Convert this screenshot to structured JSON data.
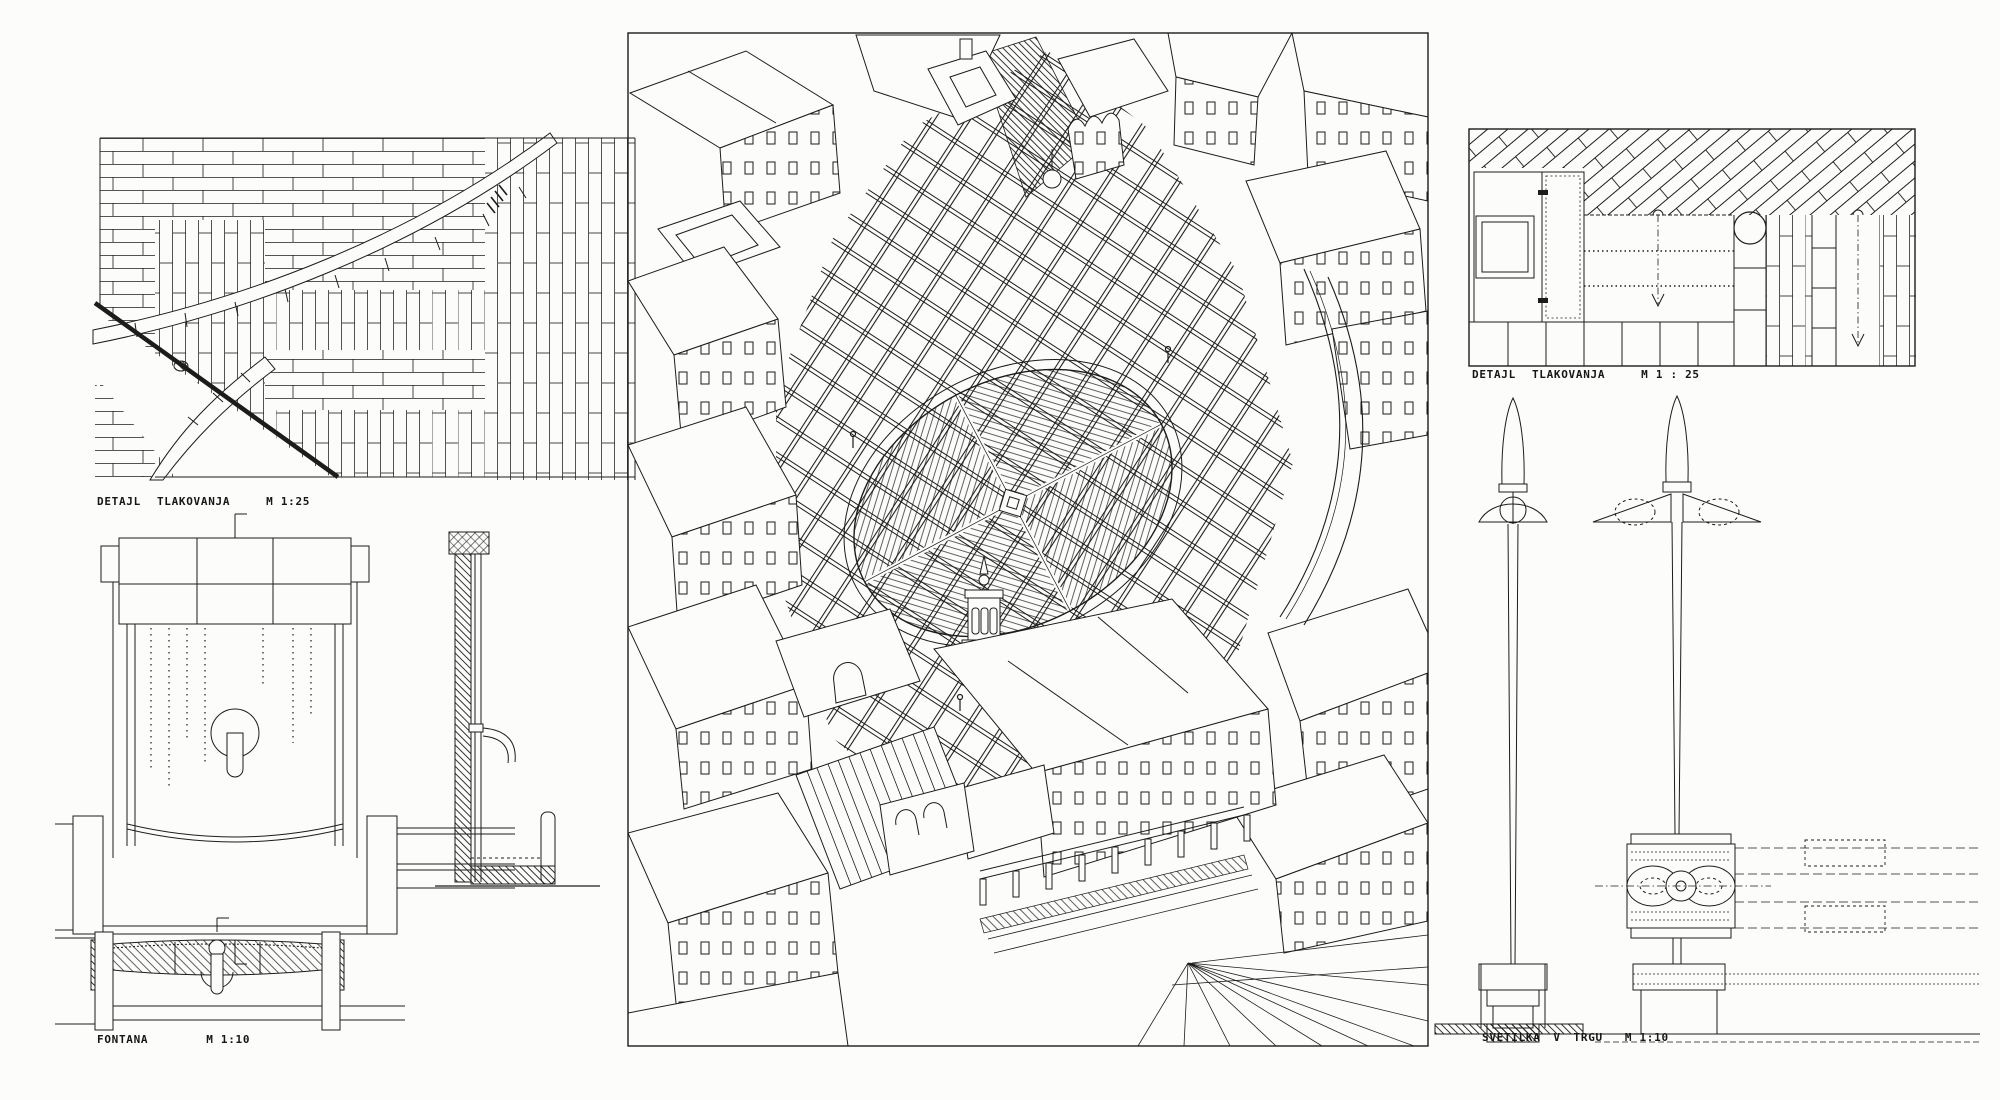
{
  "sheet": {
    "background": "#fcfcfa",
    "ink": "#1c1c1c"
  },
  "captions": {
    "paving_left": {
      "word1": "DETAJL",
      "word2": "TLAKOVANJA",
      "scale": "M 1:25"
    },
    "fountain": {
      "word1": "FONTANA",
      "scale": "M 1:10"
    },
    "paving_right": {
      "word1": "DETAJL",
      "word2": "TLAKOVANJA",
      "scale": "M 1 : 25"
    },
    "lamp": {
      "word1": "SVETILKA V TRGU",
      "scale": "M 1:10"
    }
  }
}
